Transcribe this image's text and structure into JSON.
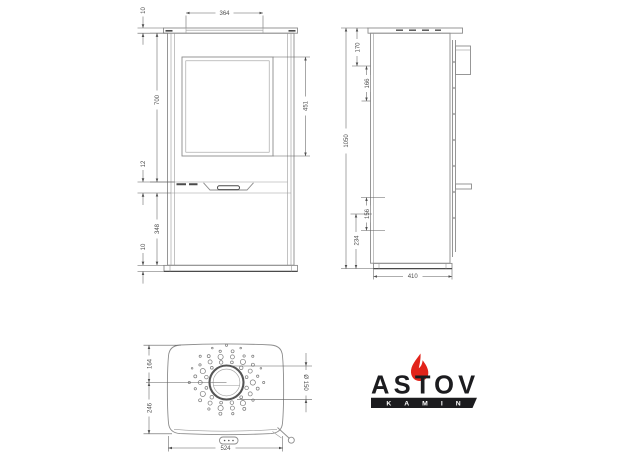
{
  "views": {
    "front": {
      "dims": {
        "cap_thickness": "10",
        "top_width": "364",
        "upper_section_height": "700",
        "glass_height": "451",
        "gap": "12",
        "lower_section_height": "348",
        "base_thickness": "10"
      }
    },
    "side": {
      "dims": {
        "top_offset": "170",
        "outlet_spacing": "166",
        "overall_height": "1050",
        "rear_upper": "156",
        "rear_lower": "234",
        "depth": "410"
      }
    },
    "top": {
      "dims": {
        "flue_to_rear": "164",
        "flue_to_front": "246",
        "width": "524",
        "flue_diameter": "Ø 150"
      }
    }
  },
  "logo": {
    "brand": "ASTOV",
    "subbrand": "KAMIN",
    "flame_color": "#e2231a",
    "text_color": "#1c1c1f"
  }
}
